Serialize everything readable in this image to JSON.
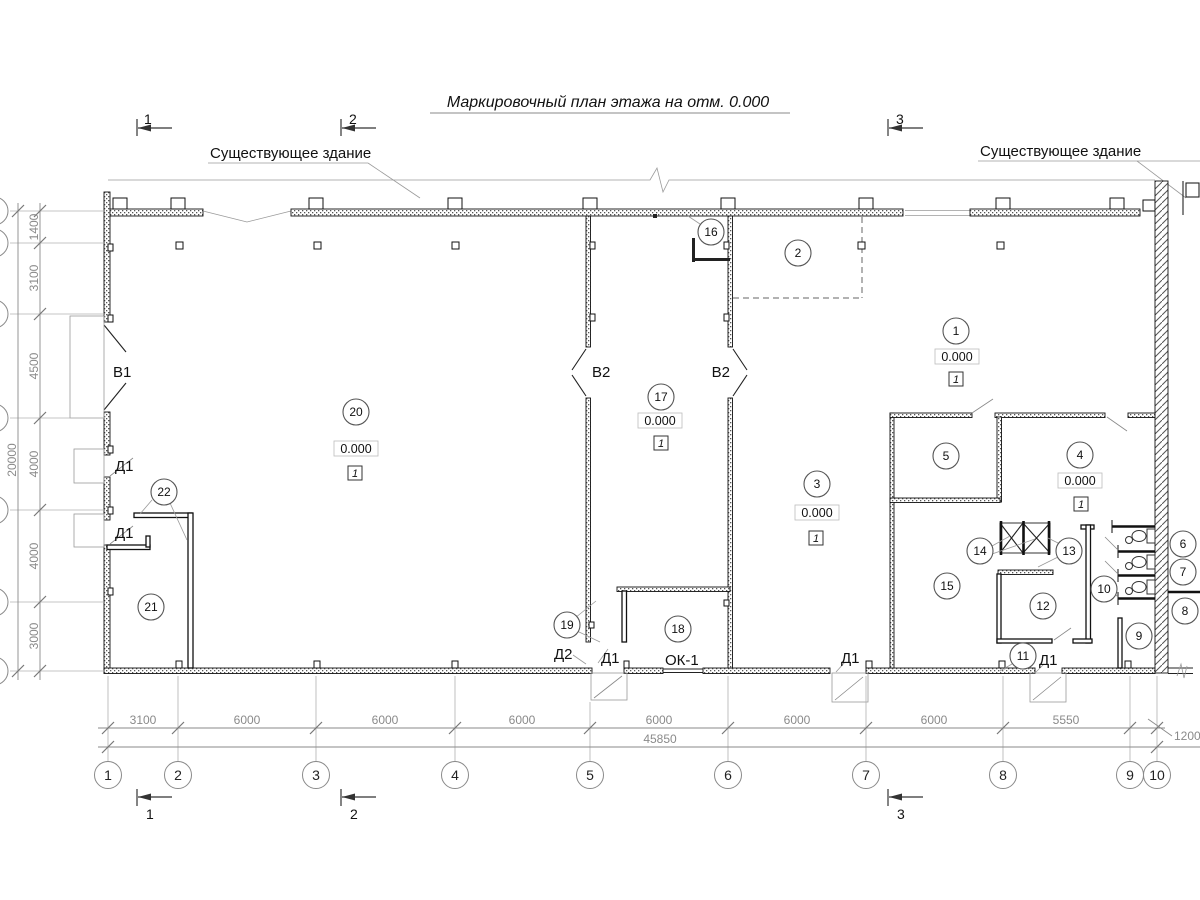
{
  "title": "Маркировочный план этажа на отм. 0.000",
  "annotations": {
    "existing_building_left": "Существующее здание",
    "existing_building_right": "Существующее здание"
  },
  "section_markers": {
    "m1": "1",
    "m2": "2",
    "m3": "3"
  },
  "axes": {
    "a1": "1",
    "a2": "2",
    "a3": "3",
    "a4": "4",
    "a5": "5",
    "a6": "6",
    "a7": "7",
    "a8": "8",
    "a9": "9",
    "a10": "10"
  },
  "dims_bottom": {
    "d12": "3100",
    "d23": "6000",
    "d34": "6000",
    "d45": "6000",
    "d56": "6000",
    "d67": "6000",
    "d78": "6000",
    "d89": "5550",
    "offset": "1200",
    "total": "45850"
  },
  "dims_left": {
    "v1": "1400",
    "v2": "3100",
    "v3": "4500",
    "v4": "4000",
    "v5": "4000",
    "v6": "3000",
    "total": "20000"
  },
  "rooms": {
    "r1": "1",
    "r2": "2",
    "r3": "3",
    "r4": "4",
    "r5": "5",
    "r6": "6",
    "r7": "7",
    "r8": "8",
    "r9": "9",
    "r10": "10",
    "r11": "11",
    "r12": "12",
    "r13": "13",
    "r14": "14",
    "r15": "15",
    "r16": "16",
    "r17": "17",
    "r18": "18",
    "r19": "19",
    "r20": "20",
    "r21": "21",
    "r22": "22"
  },
  "marks": {
    "elevation": "0.000",
    "floor_type": "1"
  },
  "openings": {
    "v1": "В1",
    "v2": "В2",
    "d1": "Д1",
    "d2": "Д2",
    "ok1": "ОК-1"
  }
}
